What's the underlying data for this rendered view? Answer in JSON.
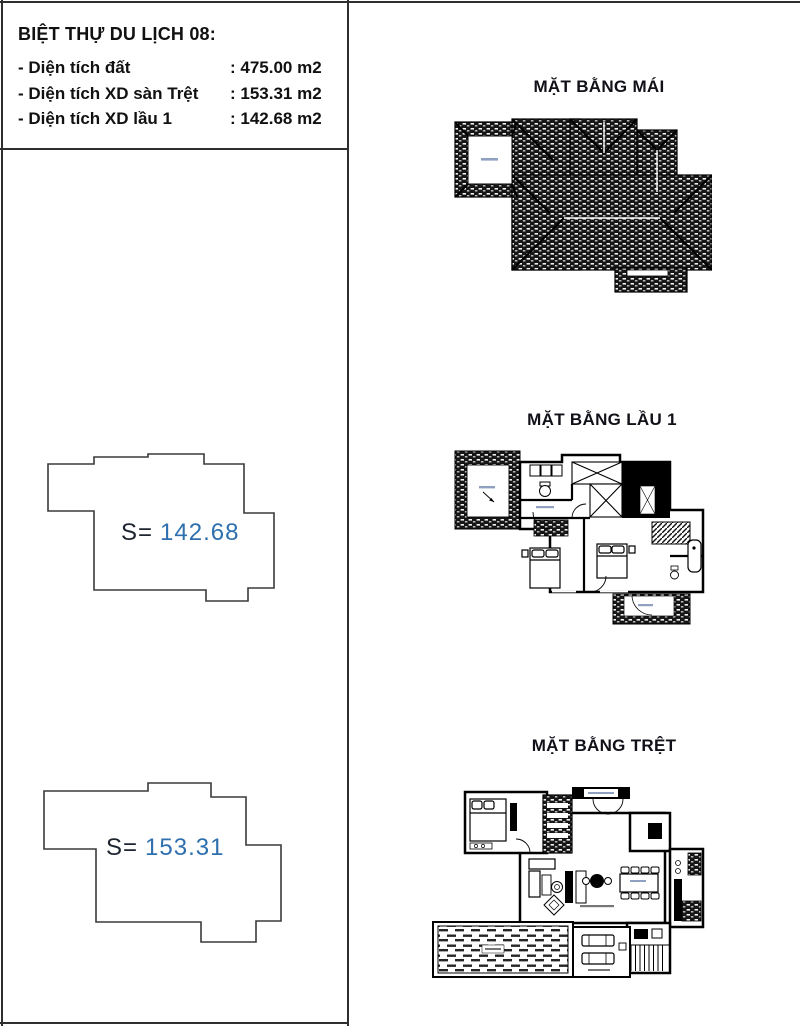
{
  "info": {
    "title": "BIỆT THỰ DU LỊCH 08:",
    "rows": [
      {
        "label": "- Diện tích đất",
        "value": ": 475.00 m2"
      },
      {
        "label": "- Diện tích XD sàn Trệt",
        "value": ": 153.31 m2"
      },
      {
        "label": "- Diện tích XD lầu 1",
        "value": ": 142.68 m2"
      }
    ]
  },
  "outlines": [
    {
      "prefix": "S=",
      "value": "142.68"
    },
    {
      "prefix": "S=",
      "value": "153.31"
    }
  ],
  "plans": {
    "roof": {
      "title": "MẶT BẰNG MÁI"
    },
    "floor1": {
      "title": "MẶT BẰNG LẦU 1"
    },
    "ground": {
      "title": "MẶT BẰNG TRỆT"
    }
  },
  "colors": {
    "line": "#1f1f1f",
    "area_value_blue": "#2e6fae",
    "divider": "#2e2e2e"
  }
}
